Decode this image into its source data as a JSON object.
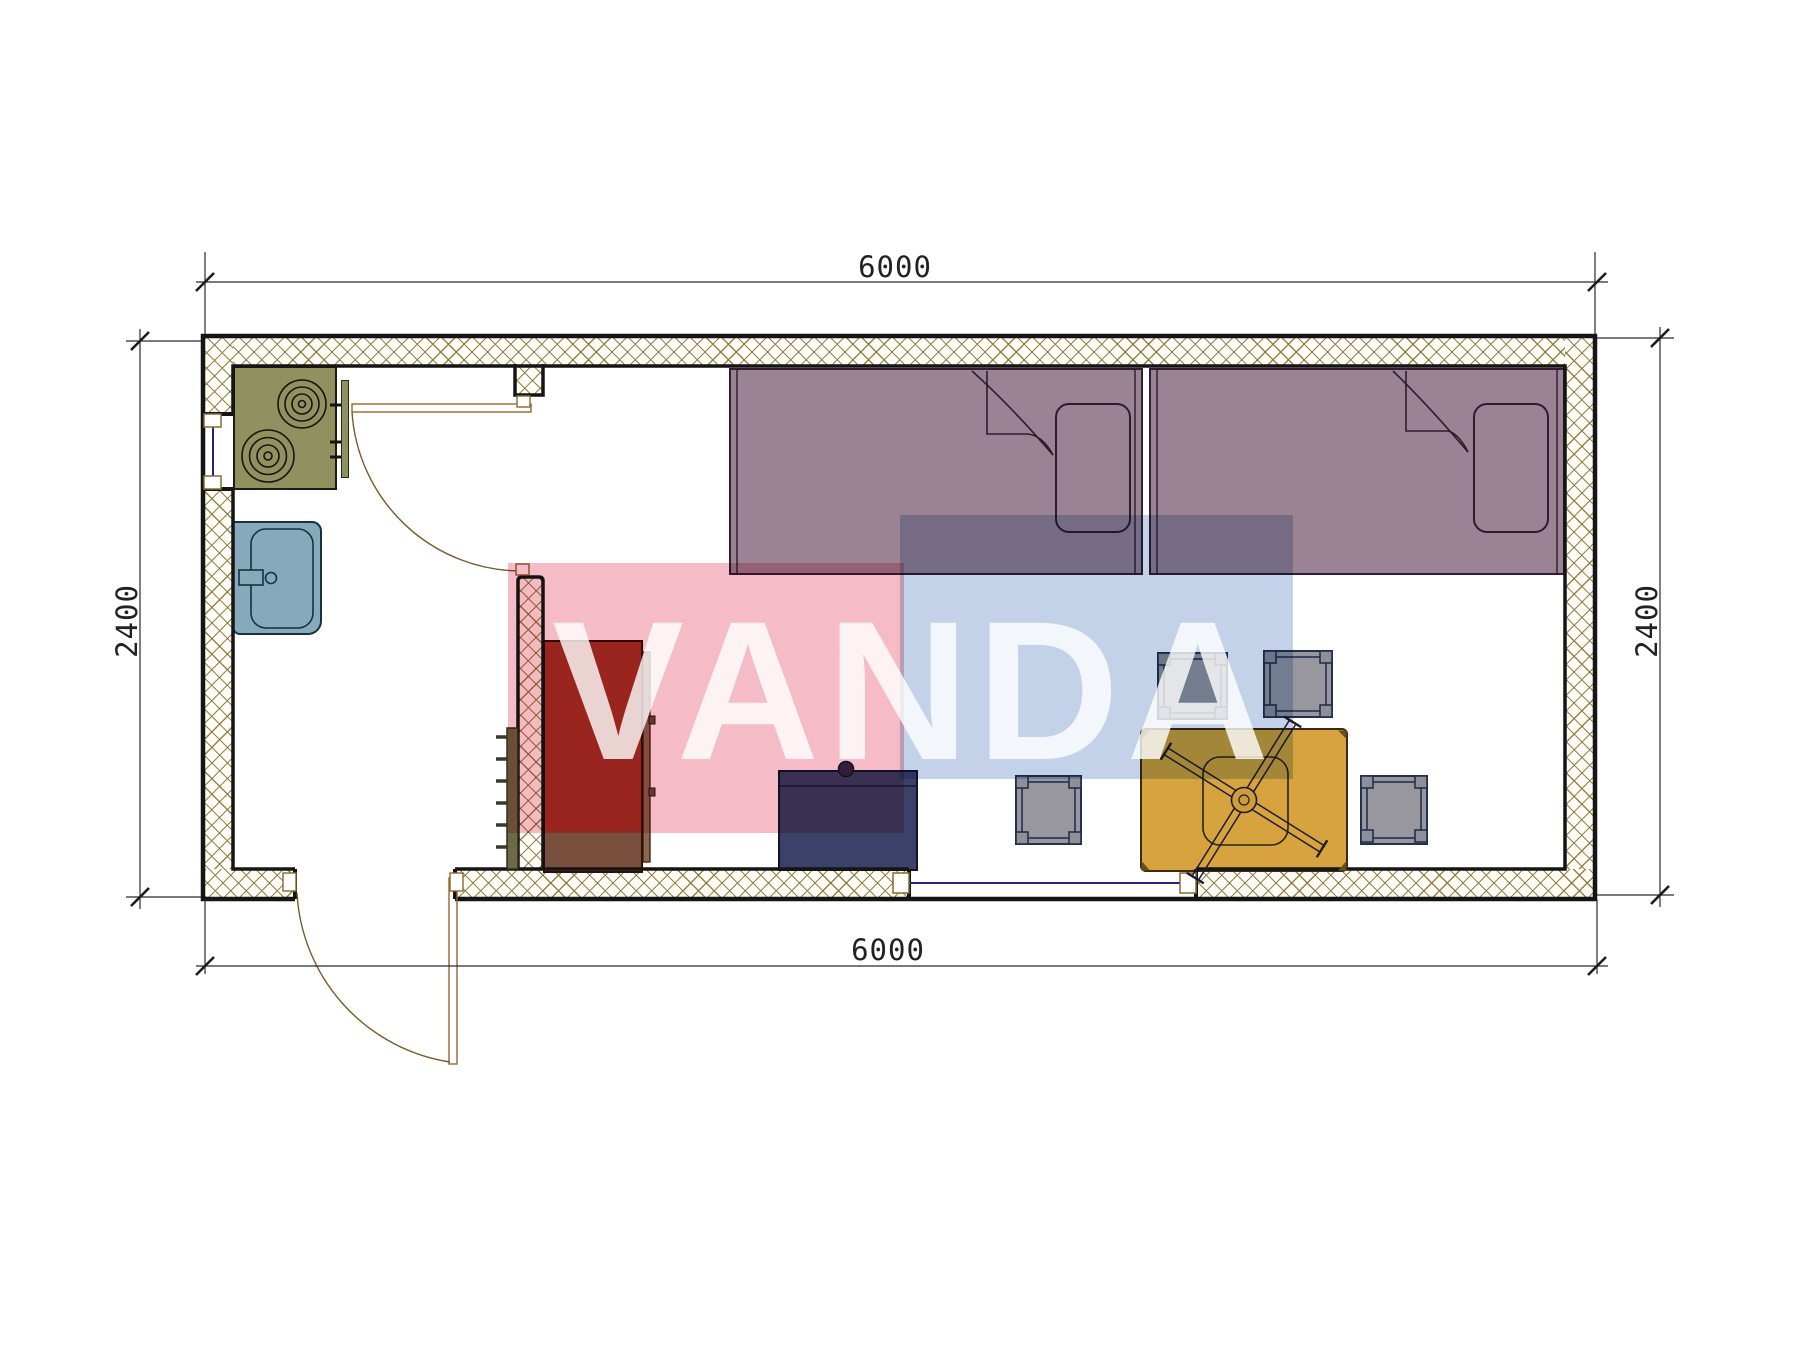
{
  "dimensions": {
    "top": "6000",
    "bottom": "6000",
    "left": "2400",
    "right": "2400"
  },
  "watermark": {
    "text": "VANDA",
    "pink_color": "#f5bcc7",
    "blue_color": "#c3d2e8",
    "text_color": "rgba(255,255,255,0.8)"
  },
  "palette": {
    "wall_line": "#151515",
    "wall_hatch": "#8a763a",
    "bed": "#9c8393",
    "stove": "#90915f",
    "sink": "#86aabb",
    "wardrobe": "#a03226",
    "wardrobe_base": "#7a4e3c",
    "dresser": "#3c4169",
    "table": "#d6a33e",
    "stool": "#97979d",
    "window_glass": "#24247a",
    "door": "#96662a",
    "dimension": "#2b2b2b"
  },
  "icons": {
    "stove": "cooktop with two burner rings",
    "sink": "kitchen sink with faucet",
    "bed_1": "single bed with pillow and folded blanket",
    "bed_2": "single bed with pillow and folded blanket",
    "wardrobe": "tall cabinet",
    "dresser": "low cabinet with knob",
    "dining_table": "table with x-frame legs",
    "stools": "four square stools",
    "doors": "two swing doors",
    "windows": "two windows"
  }
}
